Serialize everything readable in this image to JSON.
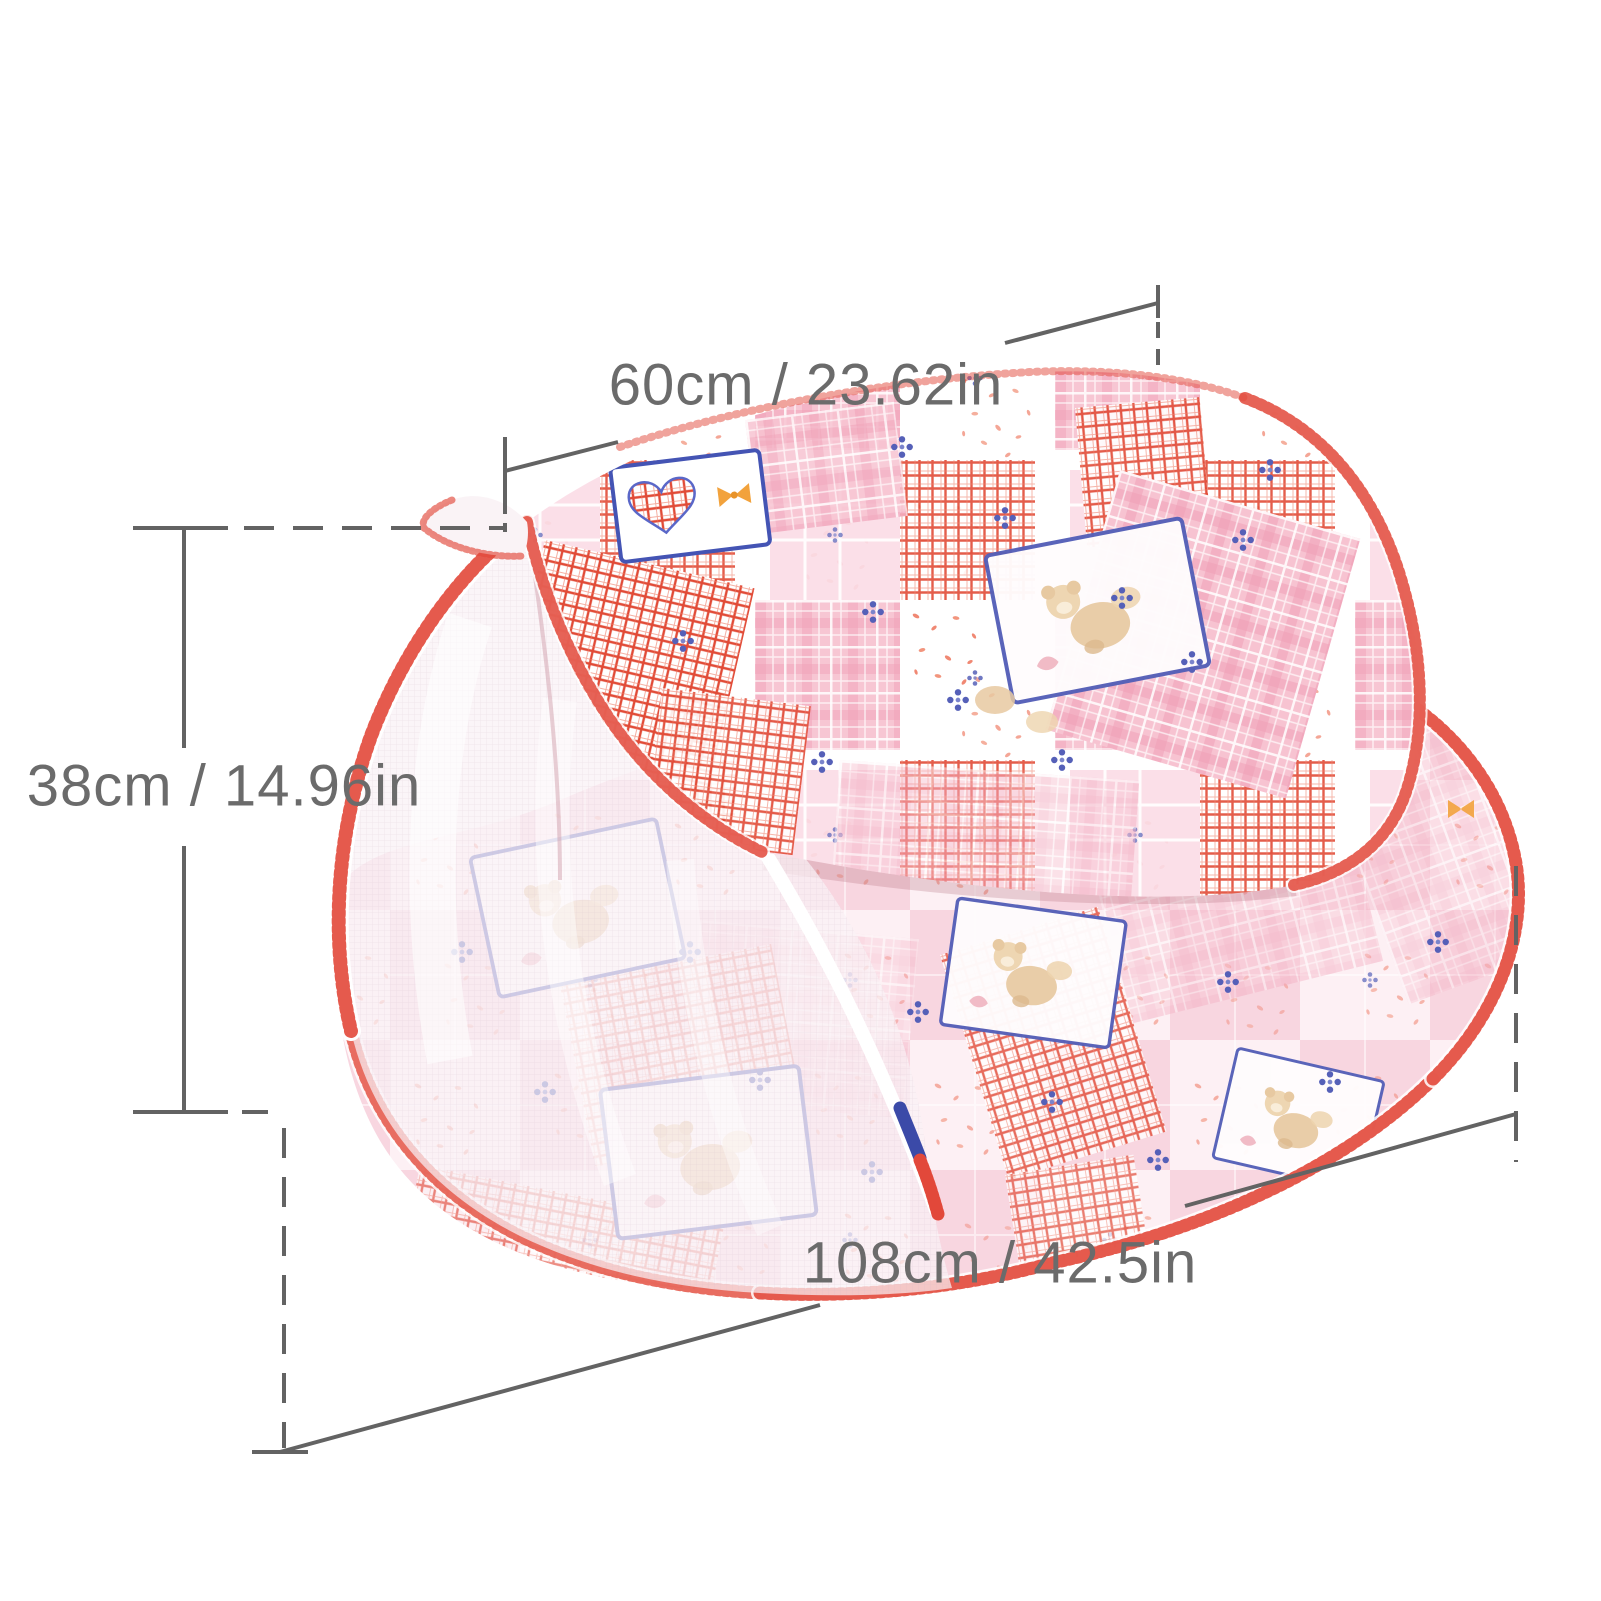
{
  "figure": {
    "subject": "pink patchwork pop-up baby mosquito-net tent with cushion base",
    "background": "#ffffff"
  },
  "dimensions": {
    "width_label": "60cm / 23.62in",
    "height_label": "38cm / 14.96in",
    "length_label": "108cm / 42.5in"
  },
  "annotation_style": {
    "line_color": "#636363",
    "label_color": "#6b6b6b"
  },
  "palette": {
    "trim_red": "#e2483a",
    "hatch_red": "#e14b37",
    "plaid_pink": "#f7c3d1",
    "deep_pink": "#ef9db5",
    "pale_pink": "#fdf0f4",
    "soft_check_pink": "#f8d3de",
    "accent_blue": "#5560b8",
    "bear_tan": "#e7c9a1",
    "accent_orange": "#f2a23c",
    "mesh_white": "#f9f1f5"
  }
}
